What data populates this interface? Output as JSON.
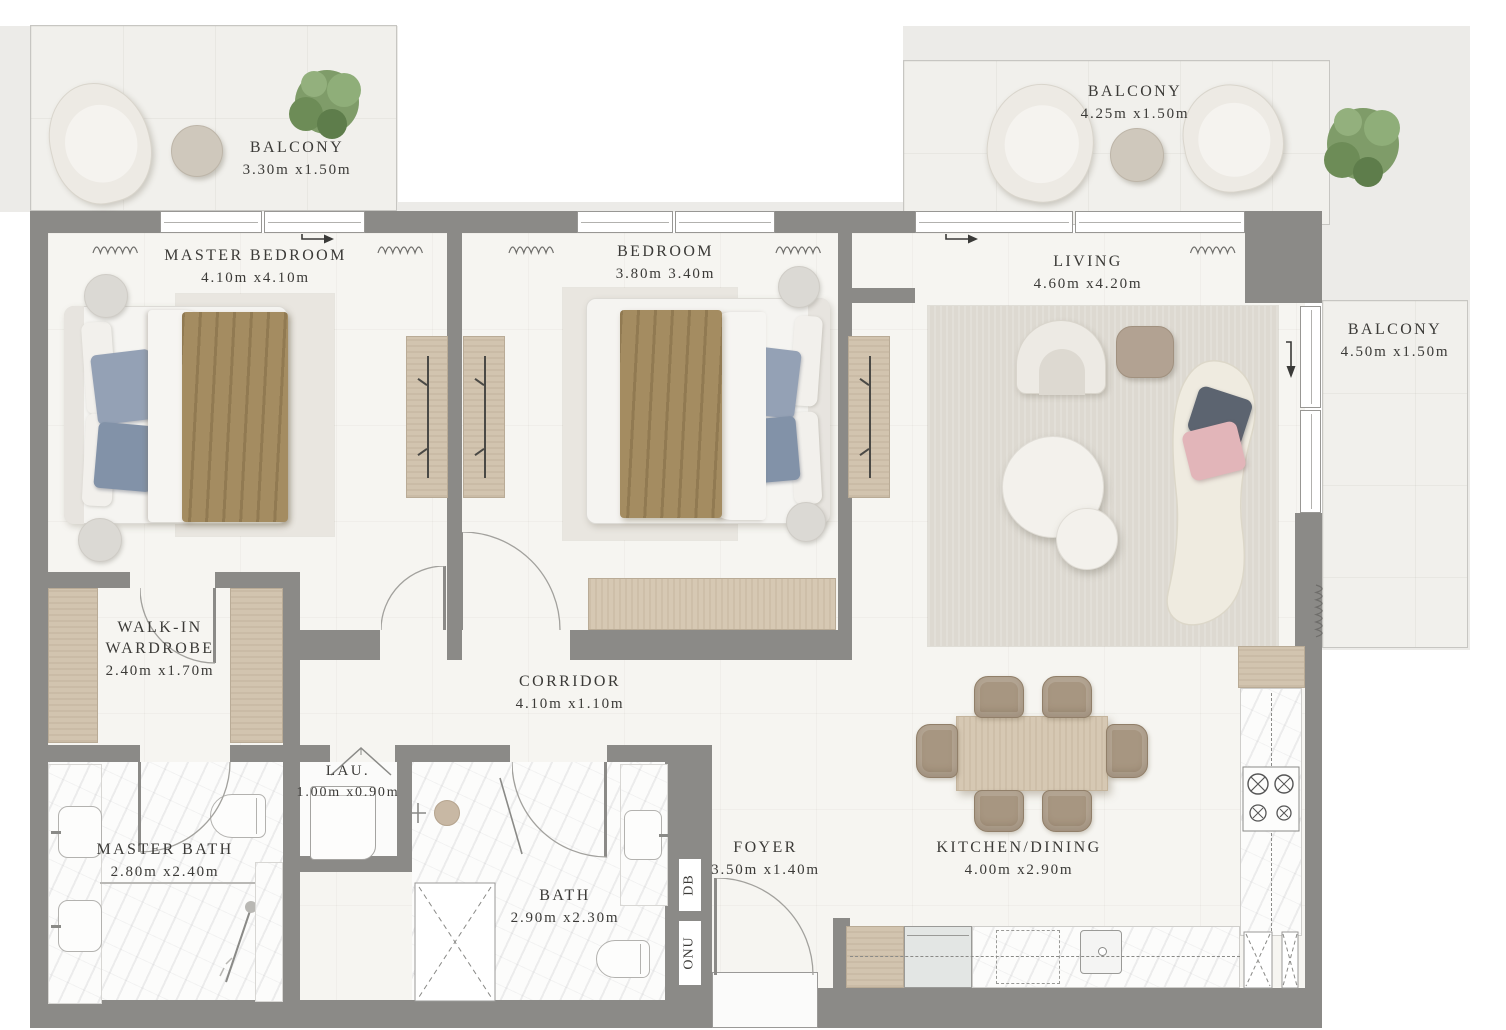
{
  "rooms": {
    "balcony_tl": {
      "name": "BALCONY",
      "dims": "3.30m x1.50m"
    },
    "master_bedroom": {
      "name": "MASTER BEDROOM",
      "dims": "4.10m x4.10m"
    },
    "bedroom": {
      "name": "BEDROOM",
      "dims": "3.80m 3.40m"
    },
    "balcony_tr": {
      "name": "BALCONY",
      "dims": "4.25m x1.50m"
    },
    "living": {
      "name": "LIVING",
      "dims": "4.60m x4.20m"
    },
    "balcony_right": {
      "name": "BALCONY",
      "dims": "4.50m x1.50m"
    },
    "walk_in": {
      "name_line1": "WALK-IN",
      "name_line2": "WARDROBE",
      "dims": "2.40m x1.70m"
    },
    "corridor": {
      "name": "CORRIDOR",
      "dims": "4.10m x1.10m"
    },
    "laundry": {
      "name": "LAU.",
      "dims": "1.00m x0.90m"
    },
    "master_bath": {
      "name": "MASTER BATH",
      "dims": "2.80m x2.40m"
    },
    "bath": {
      "name": "BATH",
      "dims": "2.90m x2.30m"
    },
    "foyer": {
      "name": "FOYER",
      "dims": "3.50m x1.40m"
    },
    "kitchen_dining": {
      "name": "KITCHEN/DINING",
      "dims": "4.00m x2.90m"
    }
  },
  "utilities": {
    "db": "DB",
    "onu": "ONU"
  },
  "colors": {
    "wall": "#8b8a87",
    "floor": "#f6f5f1",
    "balcony_floor": "#f1f0ec",
    "backdrop": "#ecebe8",
    "wood": "#d2c4af",
    "blanket": "#a48c61",
    "pillow_blue": "#94a1b5",
    "rug": "#e9e6e0",
    "living_rug": "#ddd9d1",
    "sofa": "#efebe0",
    "pillow_dark": "#5c6470",
    "pillow_pink": "#e2b5b9",
    "chair": "#a79681",
    "plant": "#7f9c69",
    "text": "#3b3a37"
  },
  "icons": {
    "door_swing": "quarter-arc",
    "window": "double-frame",
    "curtain": "squiggle-coil",
    "direction_arrow": "→",
    "stove": "4-burner-hob",
    "shower": "handheld-wand",
    "plant": "tree-canopy",
    "tall_cabinet": "dashed-x"
  }
}
